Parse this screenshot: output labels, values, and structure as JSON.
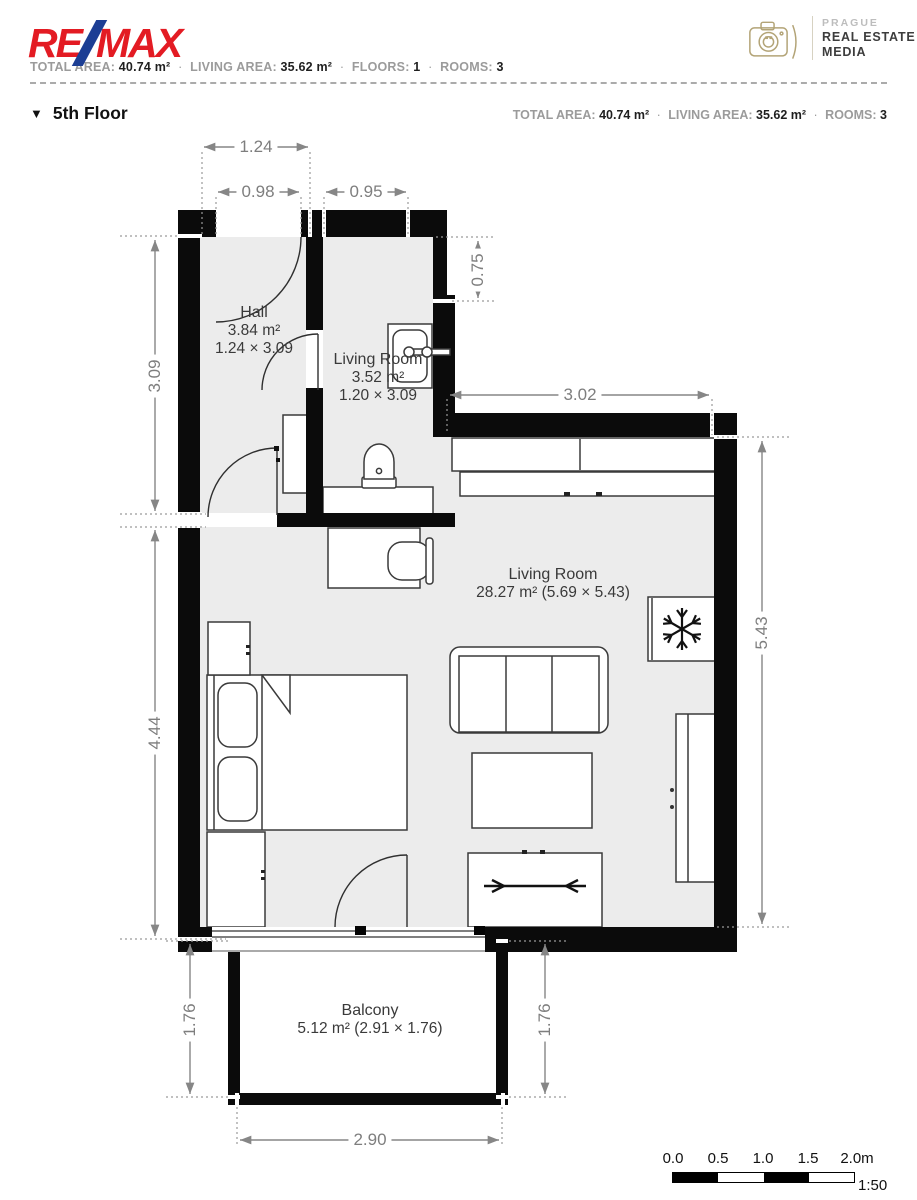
{
  "header": {
    "brand": {
      "re": "RE",
      "slash": "/",
      "max": "MAX"
    },
    "separator": "·",
    "stats": [
      {
        "label": "TOTAL AREA:",
        "value": "40.74 m²"
      },
      {
        "label": "LIVING AREA:",
        "value": "35.62 m²"
      },
      {
        "label": "FLOORS:",
        "value": "1"
      },
      {
        "label": "ROOMS:",
        "value": "3"
      }
    ],
    "media_logo": {
      "line1": "PRAGUE",
      "line2": "REAL ESTATE",
      "line3": "MEDIA"
    }
  },
  "floor_section": {
    "marker": "▼",
    "title": "5th Floor",
    "stats": [
      {
        "label": "TOTAL AREA:",
        "value": "40.74 m²"
      },
      {
        "label": "LIVING AREA:",
        "value": "35.62 m²"
      },
      {
        "label": "ROOMS:",
        "value": "3"
      }
    ]
  },
  "rooms": {
    "hall": {
      "name": "Hall",
      "area": "3.84 m²",
      "size": "1.24 × 3.09"
    },
    "bathroom": {
      "name": "Living Room",
      "area": "3.52 m²",
      "size": "1.20 × 3.09"
    },
    "living": {
      "name": "Living Room",
      "area_size": "28.27 m² (5.69 × 5.43)"
    },
    "balcony": {
      "name": "Balcony",
      "area_size": "5.12 m² (2.91 × 1.76)"
    }
  },
  "dimensions": {
    "top_width": "1.24",
    "entrance_width": "0.98",
    "bath_width": "0.95",
    "notch_height": "0.75",
    "upper_height": "3.09",
    "kitchen_width": "3.02",
    "living_height": "5.43",
    "lower_height": "4.44",
    "balcony_height_left": "1.76",
    "balcony_height_right": "1.76",
    "balcony_width": "2.90"
  },
  "scale_bar": {
    "labels": [
      "0.0",
      "0.5",
      "1.0",
      "1.5",
      "2.0m"
    ],
    "ratio": "1:50"
  },
  "icons": {
    "floor_marker": "▼"
  },
  "colors": {
    "wall": "#0b0b0b",
    "floor": "#ececec",
    "furniture_outline": "#3a3a3a",
    "dimension": "#868686",
    "brand_red": "#e31b23",
    "brand_blue": "#1c3e94",
    "media_gold": "#b3a477"
  }
}
